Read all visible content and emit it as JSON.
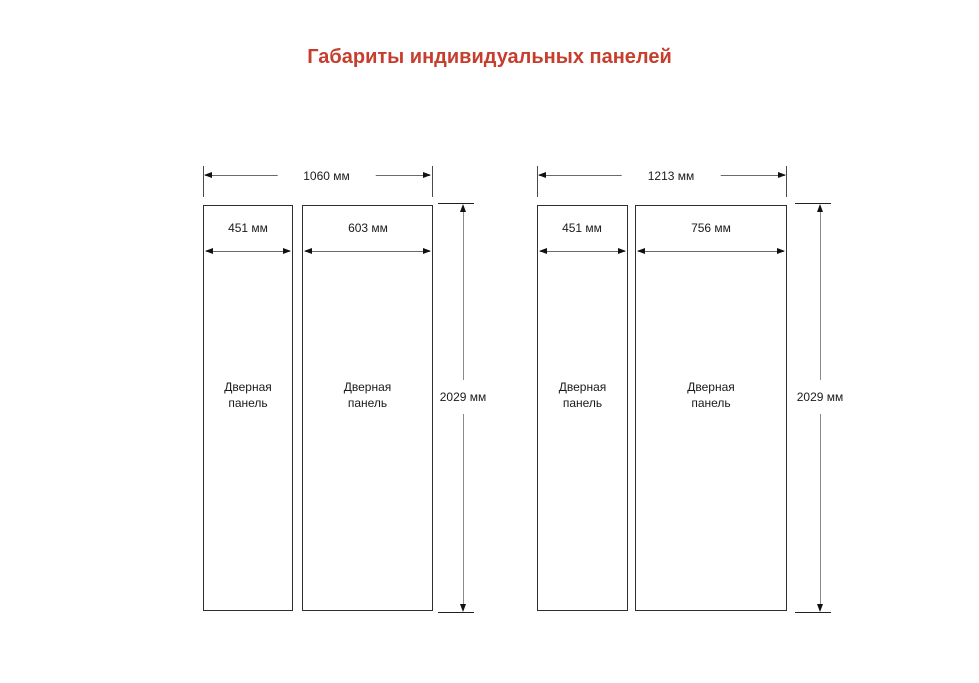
{
  "title": "Габариты индивидуальных панелей",
  "colors": {
    "accent_red": "#c63e2e",
    "text": "#1a1a1a",
    "line_gray": "#6a6a6a",
    "background": "#ffffff"
  },
  "diagrams": [
    {
      "total_width": "1060 мм",
      "total_width_mm": 1060,
      "height": "2029 мм",
      "height_mm": 2029,
      "panels": [
        {
          "width": "451 мм",
          "width_mm": 451,
          "label": "Дверная\nпанель"
        },
        {
          "width": "603 мм",
          "width_mm": 603,
          "label": "Дверная\nпанель"
        }
      ]
    },
    {
      "total_width": "1213 мм",
      "total_width_mm": 1213,
      "height": "2029 мм",
      "height_mm": 2029,
      "panels": [
        {
          "width": "451 мм",
          "width_mm": 451,
          "label": "Дверная\nпанель"
        },
        {
          "width": "756 мм",
          "width_mm": 756,
          "label": "Дверная\nпанель"
        }
      ]
    }
  ]
}
